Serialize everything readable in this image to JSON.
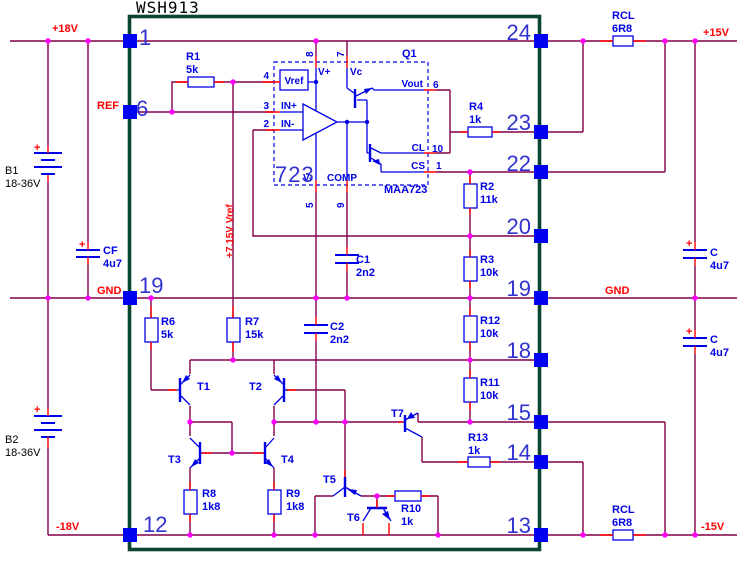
{
  "title": "WSH913",
  "colors": {
    "wire": "#80004A",
    "stub": "#FF0000",
    "component": "#0000E6",
    "junction": "#FF00FF",
    "pad": "#0000F0",
    "module_border": "#0B4534",
    "net_label": "#FF0000",
    "pin_number": "#3232D2",
    "text": "#000000",
    "background": "#FFFFFF"
  },
  "module": {
    "left_pins": [
      "1",
      "6",
      "19",
      "12"
    ],
    "right_pins": [
      "24",
      "23",
      "22",
      "20",
      "19",
      "18",
      "15",
      "14",
      "13"
    ]
  },
  "net_labels": {
    "vplus18": "+18V",
    "vminus18": "-18V",
    "vplus15": "+15V",
    "vminus15": "-15V",
    "gnd_left": "GND",
    "gnd_right": "GND",
    "ref": "REF",
    "vref_rail": "+7.15V Vref"
  },
  "ic723": {
    "designator": "723",
    "part": "MAA723",
    "output_transistor": "Q1",
    "labels": {
      "vref": "Vref",
      "in_plus": "IN+",
      "in_minus": "IN-",
      "v_plus": "V+",
      "vc": "Vc",
      "v_minus": "V-",
      "comp": "COMP",
      "cl": "CL",
      "cs": "CS",
      "vout": "Vout"
    },
    "pin_numbers": {
      "vref": "4",
      "in_plus": "3",
      "in_minus": "2",
      "v_plus": "8",
      "vc": "7",
      "v_minus": "5",
      "comp": "9",
      "vout": "6",
      "cl": "10",
      "cs": "1"
    }
  },
  "resistors": [
    {
      "id": "R1",
      "value": "5k"
    },
    {
      "id": "R2",
      "value": "11k"
    },
    {
      "id": "R3",
      "value": "10k"
    },
    {
      "id": "R4",
      "value": "1k"
    },
    {
      "id": "R6",
      "value": "5k"
    },
    {
      "id": "R7",
      "value": "15k"
    },
    {
      "id": "R8",
      "value": "1k8"
    },
    {
      "id": "R9",
      "value": "1k8"
    },
    {
      "id": "R10",
      "value": "1k"
    },
    {
      "id": "R11",
      "value": "10k"
    },
    {
      "id": "R12",
      "value": "10k"
    },
    {
      "id": "R13",
      "value": "1k"
    },
    {
      "id": "RCL",
      "value": "6R8"
    },
    {
      "id": "RCL",
      "value": "6R8"
    }
  ],
  "capacitors": [
    {
      "id": "C1",
      "value": "2n2"
    },
    {
      "id": "C2",
      "value": "2n2"
    },
    {
      "id": "CF",
      "value": "4u7",
      "polarity": "+"
    },
    {
      "id": "C",
      "value": "4u7",
      "polarity": "+"
    },
    {
      "id": "C",
      "value": "4u7",
      "polarity": "+"
    }
  ],
  "batteries": [
    {
      "id": "B1",
      "value": "18-36V",
      "polarity": "+"
    },
    {
      "id": "B2",
      "value": "18-36V",
      "polarity": "+"
    }
  ],
  "transistors": [
    "T1",
    "T2",
    "T3",
    "T4",
    "T5",
    "T6",
    "T7"
  ]
}
